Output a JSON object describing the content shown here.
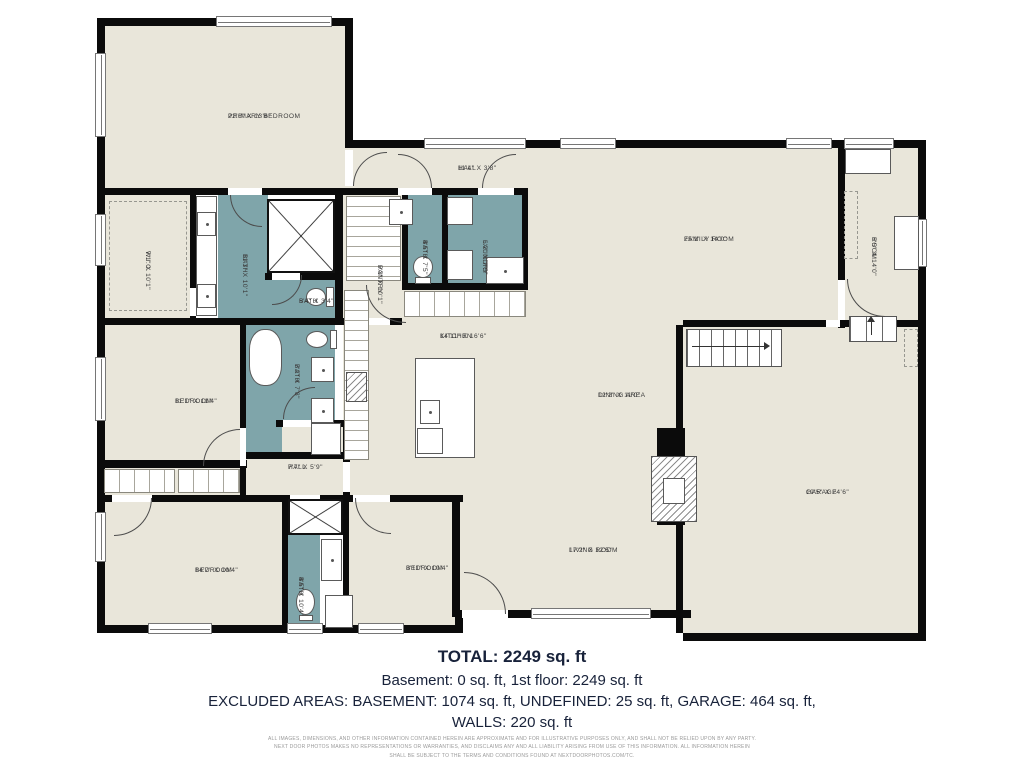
{
  "floorplan": {
    "rooms": [
      {
        "id": "primary-bedroom",
        "name": "PRIMARY BEDROOM",
        "dims": "22'6\" X 13'6\""
      },
      {
        "id": "hall-top",
        "name": "HALL",
        "dims": "11'4\" X 3'8\""
      },
      {
        "id": "family-room",
        "name": "FAMILY ROOM",
        "dims": "25'1\" X 14'0\""
      },
      {
        "id": "room",
        "name": "ROOM",
        "dims": "6'5\" X 14'0\""
      },
      {
        "id": "wic",
        "name": "W.I.C.",
        "dims": "7'1\" X 10'1\""
      },
      {
        "id": "bath-primary",
        "name": "BATH",
        "dims": "11'3\" X 10'1\""
      },
      {
        "id": "bath-small",
        "name": "BATH",
        "dims": "5'4\" X 3'4\""
      },
      {
        "id": "pantry",
        "name": "PANTRY",
        "dims": "5'3\" X 10'1\""
      },
      {
        "id": "bath-top",
        "name": "BATH",
        "dims": "4'5\" X 7'5\""
      },
      {
        "id": "laundry",
        "name": "LAUNDRY",
        "dims": "6'2\" X 7'5\""
      },
      {
        "id": "kitchen",
        "name": "KITCHEN",
        "dims": "14'11\" X 16'6\""
      },
      {
        "id": "dining-area",
        "name": "DINING AREA",
        "dims": "12'2\" X 11'0\""
      },
      {
        "id": "bedroom-mid",
        "name": "BEDROOM",
        "dims": "11'1\" X 11'4\""
      },
      {
        "id": "bath-mid",
        "name": "BATH",
        "dims": "7'2\" X 7'8\""
      },
      {
        "id": "hall-mid",
        "name": "HALL",
        "dims": "7'7\" X 5'9\""
      },
      {
        "id": "bedroom-bottom-left",
        "name": "BEDROOM",
        "dims": "14'7\" X 10'4\""
      },
      {
        "id": "bath-bottom",
        "name": "BATH",
        "dims": "4'5\" X 10'4\""
      },
      {
        "id": "bedroom-bottom-mid",
        "name": "BEDROOM",
        "dims": "8'11\" X 10'4\""
      },
      {
        "id": "living-room",
        "name": "LIVING ROOM",
        "dims": "17'2\" X 12'5\""
      },
      {
        "id": "garage",
        "name": "GARAGE",
        "dims": "19'5\" X 24'6\""
      }
    ],
    "summary": {
      "total": "TOTAL: 2249 sq. ft",
      "line2": "Basement: 0 sq. ft, 1st floor: 2249 sq. ft",
      "line3": "EXCLUDED AREAS: BASEMENT: 1074 sq. ft, UNDEFINED: 25 sq. ft, GARAGE: 464 sq. ft,",
      "line4": "WALLS: 220 sq. ft"
    },
    "disclaimer": [
      "ALL IMAGES, DIMENSIONS, AND OTHER INFORMATION CONTAINED HEREIN ARE APPROXIMATE AND FOR ILLUSTRATIVE PURPOSES ONLY, AND SHALL NOT BE RELIED UPON BY ANY PARTY.",
      "NEXT DOOR PHOTOS MAKES NO REPRESENTATIONS OR WARRANTIES, AND DISCLAIMS ANY AND ALL LIABILITY ARISING FROM USE OF THIS INFORMATION. ALL INFORMATION HEREIN",
      "SHALL BE SUBJECT TO THE TERMS AND CONDITIONS FOUND AT NEXTDOORPHOTOS.COM/TC."
    ],
    "colors": {
      "floor": "#e9e6da",
      "wet_area": "#7fa5aa",
      "wall": "#0b0b0b"
    }
  }
}
